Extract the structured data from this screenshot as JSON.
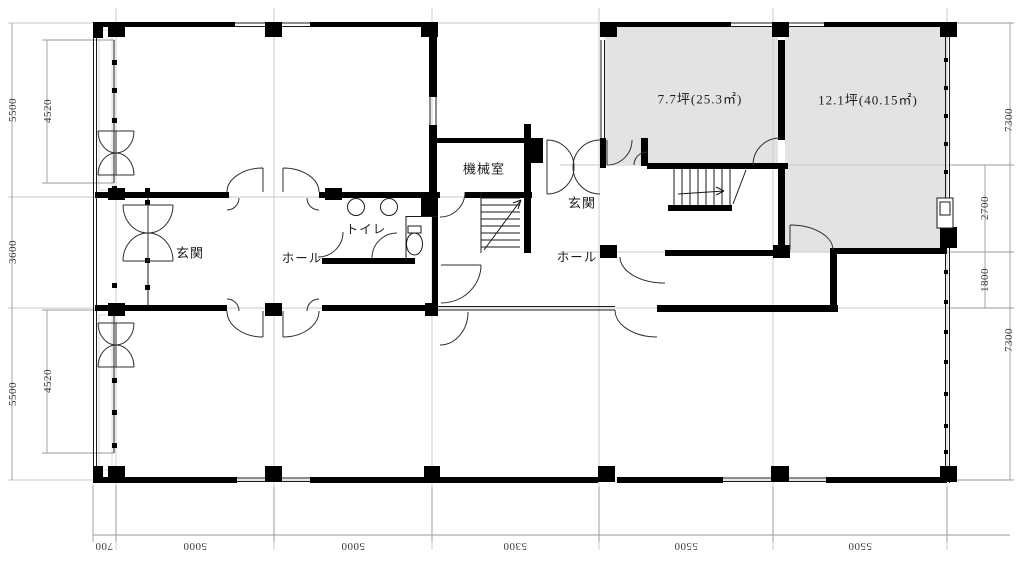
{
  "drawing": {
    "type": "floor-plan",
    "rooms": {
      "machine_room": "機械室",
      "toilet": "トイレ",
      "entrance_left": "玄関",
      "hall_left": "ホール",
      "entrance_right": "玄関",
      "hall_right": "ホール",
      "unit_a_area": "7.7坪(25.3㎡)",
      "unit_b_area": "12.1坪(40.15㎡)"
    },
    "dims": {
      "left_outer": [
        "5500",
        "3600",
        "5500"
      ],
      "left_inner": [
        "4520",
        "4520"
      ],
      "right_outer": [
        "7300",
        "7300"
      ],
      "right_inner": [
        "2700",
        "1800"
      ],
      "bottom": [
        "700",
        "5000",
        "5000",
        "5300",
        "5500",
        "5500"
      ]
    },
    "colors": {
      "wall": "#000000",
      "leased_room_fill": "#e3e3e3",
      "grid_line": "#c9c9c9",
      "dim_line": "#9a9a9a",
      "background": "#ffffff"
    }
  }
}
